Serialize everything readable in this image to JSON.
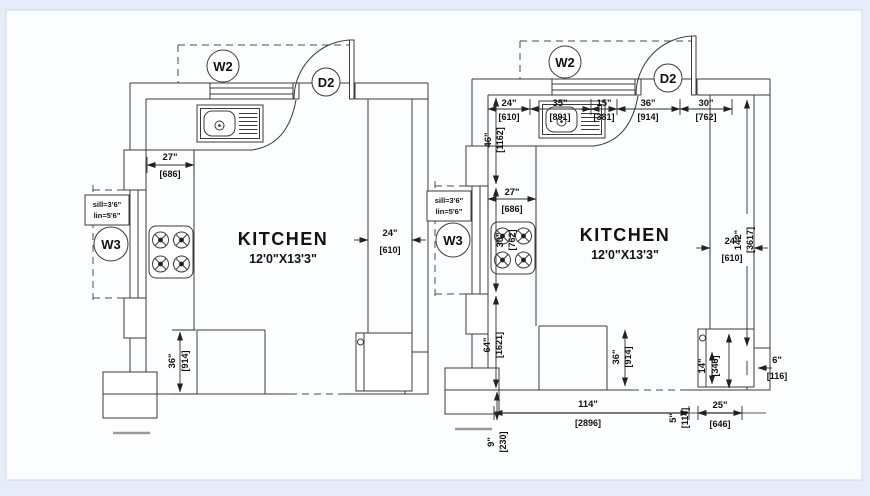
{
  "page": {
    "background": "#e7edf8",
    "canvas": "#fcfdff",
    "line_color": "#3b3b3b"
  },
  "labels": {
    "w2": "W2",
    "d2": "D2",
    "w3": "W3",
    "kitchen": "KITCHEN",
    "kitchen_size": "12'0\"X13'3\"",
    "sill1": "sill=3'6\"",
    "sill2": "lin=5'6\""
  },
  "left": {
    "top_counter": {
      "in": "27\"",
      "mm": "[686]"
    },
    "right_counter": {
      "in": "24\"",
      "mm": "[610]"
    },
    "peninsula": {
      "in": "36\"",
      "mm": "[914]"
    }
  },
  "right": {
    "top": [
      {
        "in": "24\"",
        "mm": "[610]"
      },
      {
        "in": "35\"",
        "mm": "[891]"
      },
      {
        "in": "15\"",
        "mm": "[381]"
      },
      {
        "in": "36\"",
        "mm": "[914]"
      },
      {
        "in": "30\"",
        "mm": "[762]"
      }
    ],
    "left_chain": [
      {
        "in": "46\"",
        "mm": "[1162]"
      },
      {
        "in": "30\"",
        "mm": "[762]"
      },
      {
        "in": "64\"",
        "mm": "[1621]"
      },
      {
        "in": "9\"",
        "mm": "[230]"
      }
    ],
    "left_counter": {
      "in": "27\"",
      "mm": "[686]"
    },
    "side": [
      {
        "in": "24\"",
        "mm": "[610]"
      },
      {
        "in": "142\"",
        "mm": "[3617]"
      }
    ],
    "bottom": [
      {
        "in": "36\"",
        "mm": "[914]"
      },
      {
        "in": "114\"",
        "mm": "[2896]"
      },
      {
        "in": "5\"",
        "mm": "[114]"
      },
      {
        "in": "25\"",
        "mm": "[646]"
      },
      {
        "in": "14\"",
        "mm": "[346]"
      },
      {
        "in": "6\"",
        "mm": "[116]"
      }
    ]
  }
}
